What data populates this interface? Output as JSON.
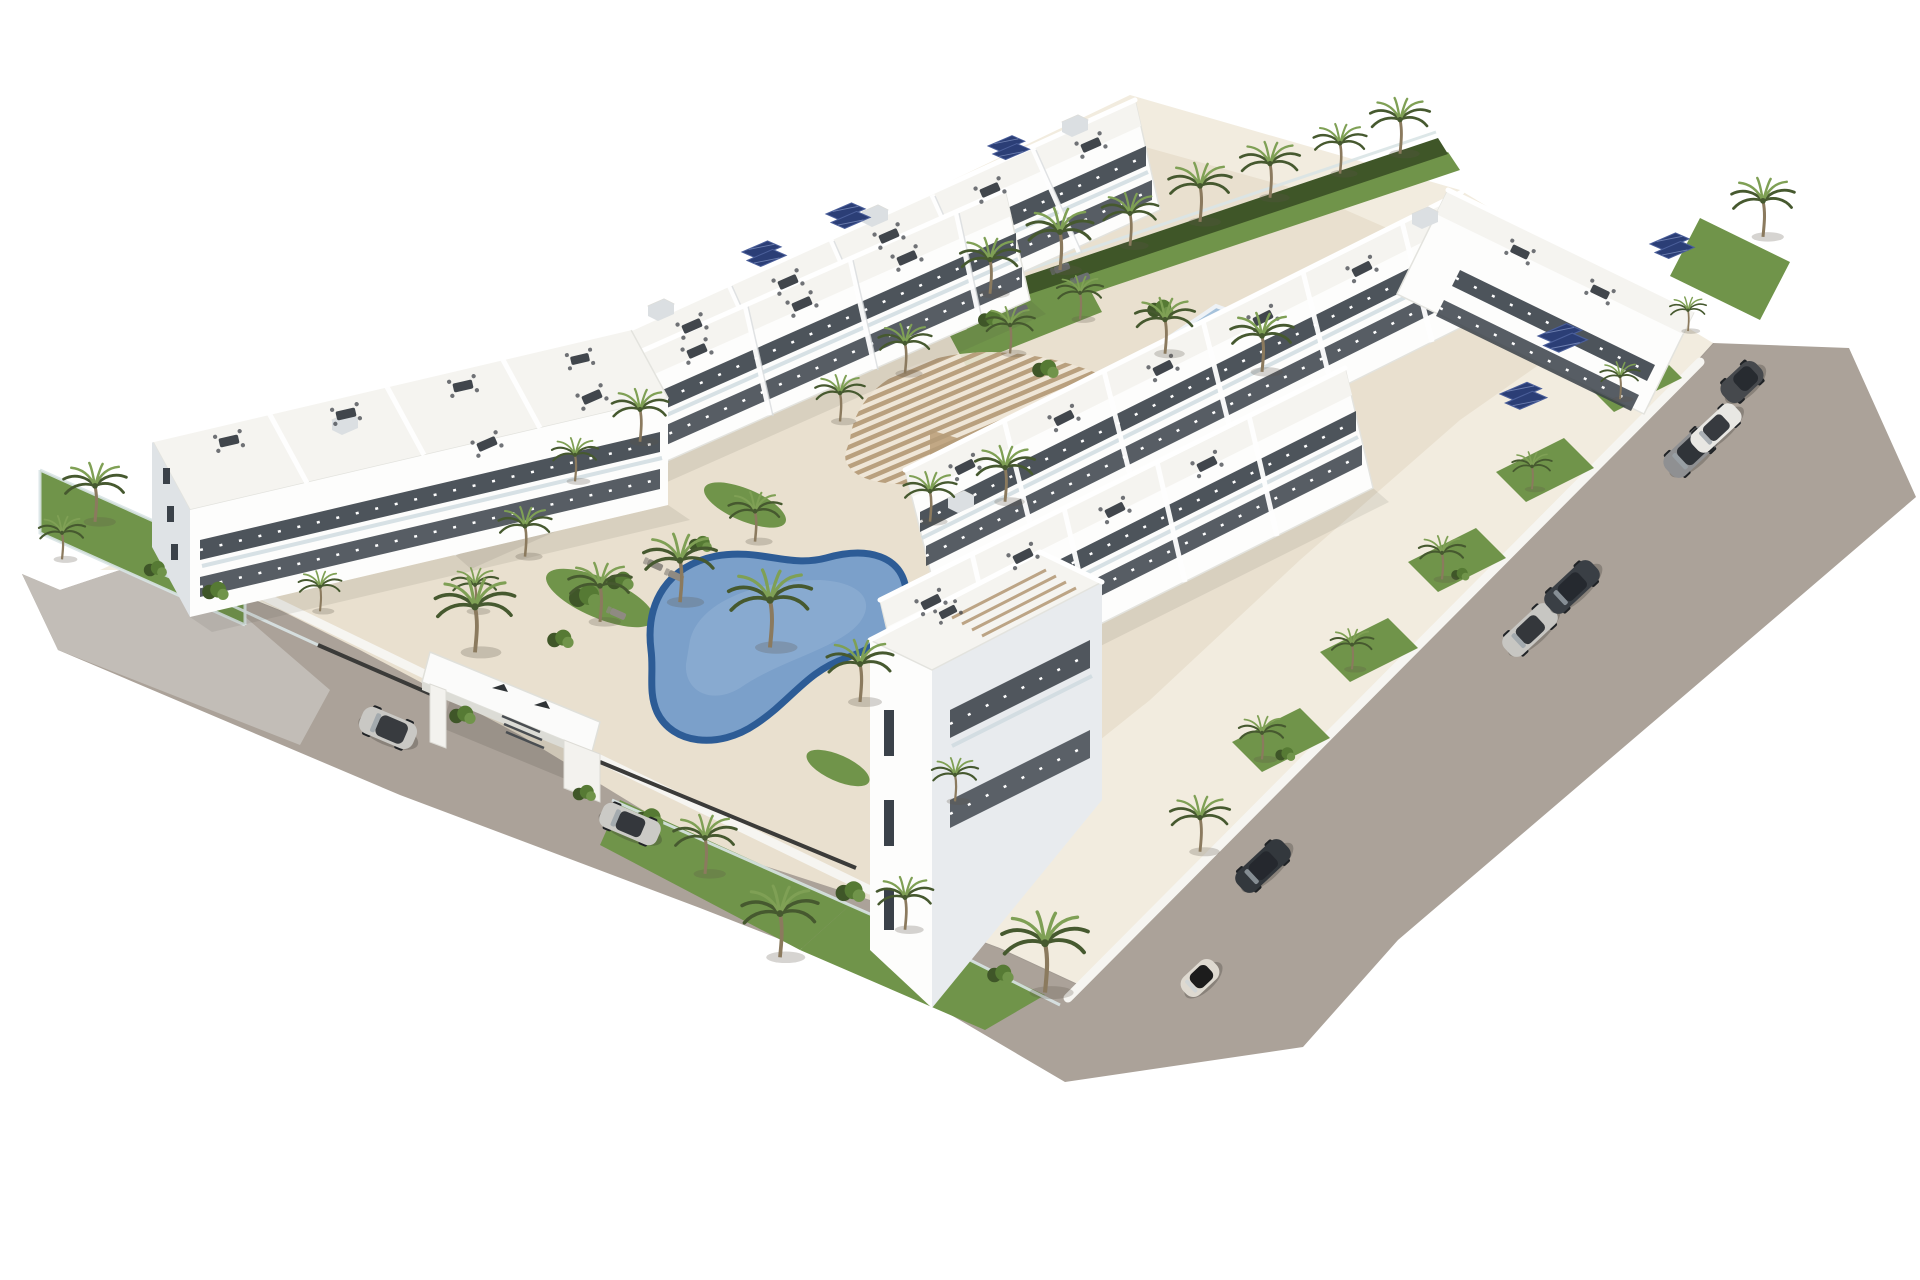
{
  "meta": {
    "title": "Aerial 3D architectural rendering of a white Mediterranean apartment complex",
    "style": "photoreal render on white background, isometric aerial view"
  },
  "palette": {
    "background": "#ffffff",
    "road": "#aba299",
    "road_light": "#c6c2bc",
    "deck": "#e9e0cf",
    "deck_light": "#f2ecdf",
    "building_white": "#fdfdfc",
    "building_roof": "#f5f4f0",
    "building_shade": "#e2e6e9",
    "building_dark_face": "#c8ced3",
    "window": "#3a4149",
    "glass_rail": "#cddade",
    "pool_water": "#7ba0ca",
    "pool_rim": "#2d5c96",
    "pool_highlight": "#98b5d6",
    "lap_pool_water": "#a6c2db",
    "lap_pool_deep": "#6a92bf",
    "pergola_wood": "#b69c7a",
    "pergola_wall": "#c2a885",
    "grass": "#70944a",
    "hedge": "#3f5628",
    "palm_dark": "#46592f",
    "palm_light": "#7fa055",
    "trunk": "#8b7a5e",
    "fence_dark": "#3b3b39",
    "solar_panel": "#2b3e76",
    "roof_furniture": "#41464c",
    "shadow": "rgba(70,65,55,0.18)"
  },
  "scene": {
    "site": {
      "name": "gated residential development",
      "ground": "L-shaped perimeter road around a central landscaped courtyard"
    },
    "buildings": [
      {
        "name": "top-back-terraced-row",
        "floors": 3,
        "features": "stepped rooftop terraces with dining sets, solar panels"
      },
      {
        "name": "top-front-terraced-row",
        "floors": 3,
        "features": "stepped rooftop terraces, balconies with glass railings"
      },
      {
        "name": "left-block",
        "floors": 4,
        "features": "tall end wall with slit windows, balconies facing courtyard"
      },
      {
        "name": "right-back-row",
        "floors": 3,
        "features": "roof terraces, solar panel arrays"
      },
      {
        "name": "right-front-row",
        "floors": 3,
        "features": "roof terraces facing central pool"
      },
      {
        "name": "bottom-corner-tower",
        "floors": 4,
        "features": "rooftop pergola slats, private garden with glass fence"
      },
      {
        "name": "far-right-strip",
        "floors": 3,
        "features": "street-facing gardens, solar panels"
      }
    ],
    "pools": [
      {
        "name": "central-kidney-pool",
        "shape": "kidney / organic",
        "water_color": "#7ba0ca",
        "rim_color": "#2d5c96"
      },
      {
        "name": "upper-lap-pool",
        "shape": "rectangular",
        "water_color": "#a6c2db",
        "in_pool_loungers": 3
      }
    ],
    "pergola": {
      "name": "organic-canopy-pergola",
      "material": "wood slats",
      "color": "#b69c7a"
    },
    "entrance": {
      "name": "entrance-gate-portal",
      "color": "white",
      "detail": "flat canopy slab with two dark roof vents, planters at pillars"
    },
    "vegetation": {
      "palm_trees": 41,
      "hedges_and_bushes": 14,
      "lawns": 9
    },
    "cars": [
      {
        "id": "car-1",
        "type": "suv",
        "color": "#c9c8c4",
        "location": "left road, upper"
      },
      {
        "id": "car-2",
        "type": "sedan",
        "color": "#cbcac6",
        "location": "left road, below entrance gate"
      },
      {
        "id": "car-3",
        "type": "fiat",
        "color": "#ded9d0",
        "location": "bottom road, near corner tower"
      },
      {
        "id": "car-4",
        "type": "sedan",
        "color": "#33383d",
        "location": "right road, lower"
      },
      {
        "id": "car-5",
        "type": "sedan",
        "color": "#c7c6c2",
        "location": "right road, middle"
      },
      {
        "id": "car-6",
        "type": "sedan",
        "color": "#3a3f45",
        "location": "right road, middle upper"
      },
      {
        "id": "car-7",
        "type": "suv",
        "color": "#8f9092",
        "location": "right road, upper pair"
      },
      {
        "id": "car-8",
        "type": "sedan",
        "color": "#e8e7e3",
        "location": "right road, upper pair"
      },
      {
        "id": "car-9",
        "type": "hatch",
        "color": "#46494d",
        "location": "right road, top"
      }
    ],
    "solar_arrays": 6,
    "rooftop_furniture_sets": 26
  }
}
